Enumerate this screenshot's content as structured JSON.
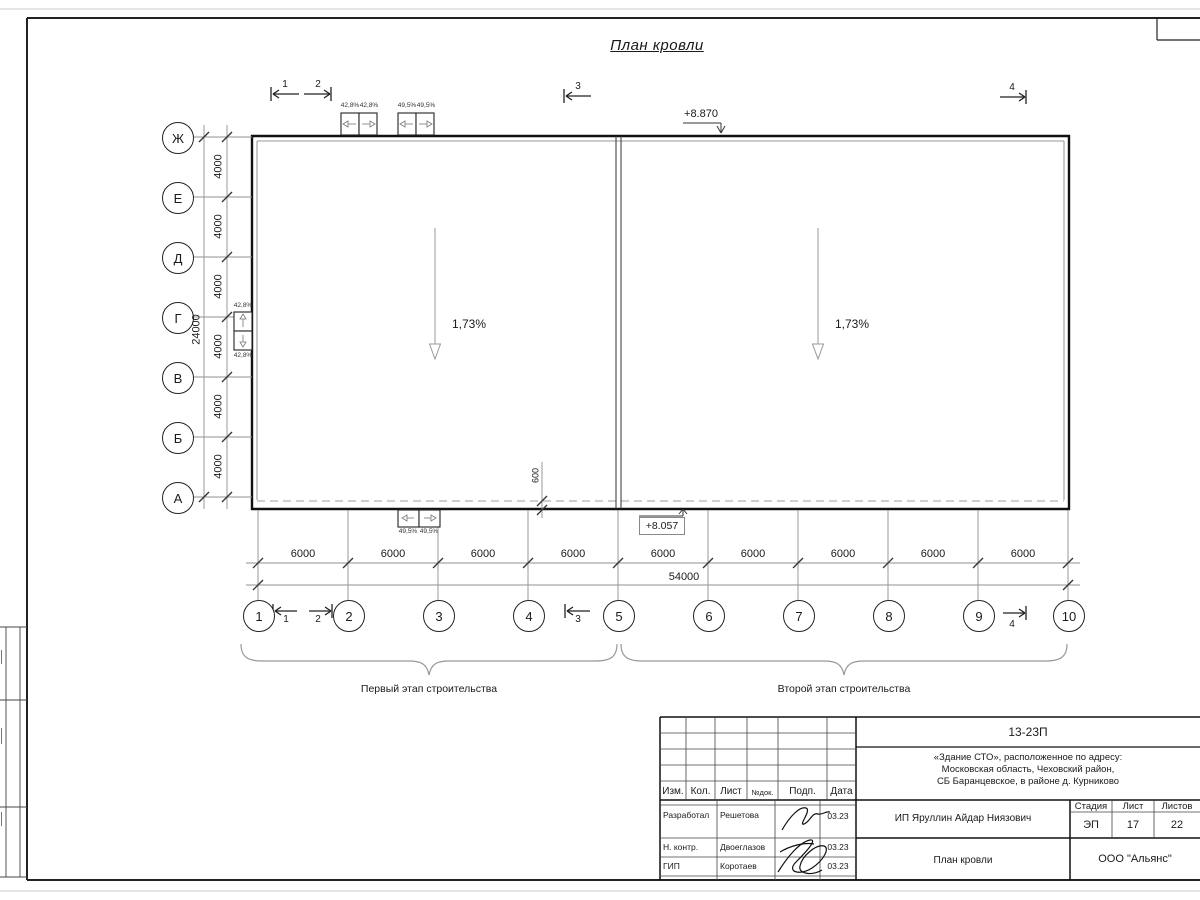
{
  "title": "План кровли",
  "axes": {
    "rows": [
      "Ж",
      "Е",
      "Д",
      "Г",
      "В",
      "Б",
      "А"
    ],
    "cols": [
      "1",
      "2",
      "3",
      "4",
      "5",
      "6",
      "7",
      "8",
      "9",
      "10"
    ]
  },
  "dimensions": {
    "row_segments": [
      "4000",
      "4000",
      "4000",
      "4000",
      "4000",
      "4000"
    ],
    "row_total": "24000",
    "col_segments": [
      "6000",
      "6000",
      "6000",
      "6000",
      "6000",
      "6000",
      "6000",
      "6000",
      "6000"
    ],
    "col_total": "54000",
    "eave_offset": "600"
  },
  "slopes": {
    "labels": [
      "1,73%",
      "1,73%"
    ]
  },
  "elevations": {
    "top": "+8.870",
    "bottom": "+8.057"
  },
  "section_marks": {
    "top": [
      "1",
      "2",
      "3",
      "4"
    ],
    "bottom": [
      "1",
      "2",
      "3",
      "4"
    ]
  },
  "vents": {
    "top_pair1": [
      "42,8%",
      "42,8%"
    ],
    "top_pair2": [
      "49,5%",
      "49,5%"
    ],
    "left_pair": [
      "42,8%",
      "42,8%"
    ],
    "bottom_pair": [
      "49,5%",
      "49,5%"
    ]
  },
  "stages": {
    "first": "Первый этап строительства",
    "second": "Второй этап строительства"
  },
  "title_block": {
    "doc_number": "13-23П",
    "address_line1": "«Здание СТО», расположенное по адресу:",
    "address_line2": "Московская область, Чеховский район,",
    "address_line3": "СБ Баранцевское, в районе д. Курниково",
    "header": [
      "Изм.",
      "Кол.",
      "Лист",
      "№док.",
      "Подп.",
      "Дата"
    ],
    "rows": [
      {
        "role": "Разработал",
        "name": "Решетова",
        "date": "03.23"
      },
      {
        "role": "Н. контр.",
        "name": "Двоеглазов",
        "date": "03.23"
      },
      {
        "role": "ГИП",
        "name": "Коротаев",
        "date": "03.23"
      }
    ],
    "client": "ИП Яруллин Айдар Ниязович",
    "stage_header": [
      "Стадия",
      "Лист",
      "Листов"
    ],
    "stage": "ЭП",
    "sheet": "17",
    "sheets": "22",
    "drawing_title": "План кровли",
    "company": "ООО \"Альянс\""
  },
  "colors": {
    "line": "#1a1a1a",
    "dim": "#909090",
    "dash": "#b0b0b0"
  }
}
